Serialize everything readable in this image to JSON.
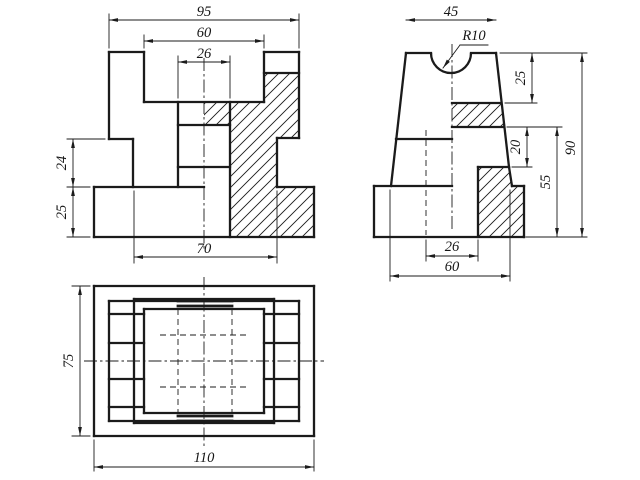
{
  "page": {
    "background": "#ffffff",
    "ink": "#1b1b1b",
    "width": 640,
    "height": 480
  },
  "views": {
    "front_view": {
      "name": "front-view-section",
      "dimensions": [
        {
          "label": "95",
          "x1": 109,
          "y1": 20,
          "x2": 299,
          "y2": 20,
          "tx": 204,
          "ty": 16,
          "rot": 0
        },
        {
          "label": "60",
          "x1": 144,
          "y1": 41,
          "x2": 264,
          "y2": 41,
          "tx": 204,
          "ty": 37,
          "rot": 0
        },
        {
          "label": "26",
          "x1": 178,
          "y1": 62,
          "x2": 230,
          "y2": 62,
          "tx": 204,
          "ty": 58,
          "rot": 0
        },
        {
          "label": "24",
          "x1": 73,
          "y1": 139,
          "x2": 73,
          "y2": 187,
          "tx": 66,
          "ty": 163,
          "rot": -90
        },
        {
          "label": "25",
          "x1": 73,
          "y1": 187,
          "x2": 73,
          "y2": 237,
          "tx": 66,
          "ty": 212,
          "rot": -90
        },
        {
          "label": "70",
          "x1": 134,
          "y1": 257,
          "x2": 277,
          "y2": 257,
          "tx": 204,
          "ty": 253,
          "rot": 0
        }
      ],
      "thick": [
        [
          109,
          52,
          144,
          52
        ],
        [
          144,
          52,
          144,
          102
        ],
        [
          144,
          102,
          264,
          102
        ],
        [
          264,
          102,
          264,
          52
        ],
        [
          264,
          52,
          299,
          52
        ],
        [
          299,
          52,
          299,
          138
        ],
        [
          299,
          138,
          277,
          138
        ],
        [
          277,
          138,
          277,
          187
        ],
        [
          277,
          187,
          314,
          187
        ],
        [
          314,
          187,
          314,
          237
        ],
        [
          314,
          237,
          94,
          237
        ],
        [
          94,
          237,
          94,
          187
        ],
        [
          94,
          187,
          204,
          187
        ],
        [
          133,
          187,
          133,
          139
        ],
        [
          133,
          139,
          109,
          139
        ],
        [
          109,
          139,
          109,
          52
        ],
        [
          264,
          73,
          299,
          73
        ],
        [
          178,
          102,
          178,
          187
        ],
        [
          230,
          102,
          230,
          237
        ],
        [
          178,
          125,
          230,
          125
        ],
        [
          178,
          167,
          230,
          167
        ]
      ],
      "thin": [
        [
          109,
          48,
          109,
          14
        ],
        [
          299,
          48,
          299,
          14
        ],
        [
          144,
          48,
          144,
          35
        ],
        [
          264,
          48,
          264,
          35
        ],
        [
          178,
          98,
          178,
          56
        ],
        [
          230,
          98,
          230,
          56
        ],
        [
          105,
          139,
          67,
          139
        ],
        [
          90,
          187,
          67,
          187
        ],
        [
          90,
          237,
          67,
          237
        ],
        [
          134,
          191,
          134,
          263
        ],
        [
          277,
          191,
          277,
          263
        ]
      ],
      "center": [
        [
          204,
          58,
          204,
          249
        ]
      ],
      "dashed": [],
      "hatch": [
        [
          [
            204,
            102
          ],
          [
            264,
            102
          ],
          [
            264,
            73
          ],
          [
            299,
            73
          ],
          [
            299,
            138
          ],
          [
            277,
            138
          ],
          [
            277,
            187
          ],
          [
            314,
            187
          ],
          [
            314,
            237
          ],
          [
            230,
            237
          ],
          [
            230,
            125
          ],
          [
            204,
            125
          ]
        ]
      ]
    },
    "side_view": {
      "name": "side-view-section",
      "dimensions": [
        {
          "label": "45",
          "x1": 406,
          "y1": 20,
          "x2": 496,
          "y2": 20,
          "tx": 451,
          "ty": 16,
          "rot": 0
        },
        {
          "label": "25",
          "x1": 532,
          "y1": 53,
          "x2": 532,
          "y2": 103,
          "tx": 525,
          "ty": 78,
          "rot": -90
        },
        {
          "label": "20",
          "x1": 527,
          "y1": 127,
          "x2": 527,
          "y2": 167,
          "tx": 520,
          "ty": 147,
          "rot": -90
        },
        {
          "label": "55",
          "x1": 557,
          "y1": 127,
          "x2": 557,
          "y2": 237,
          "tx": 550,
          "ty": 182,
          "rot": -90
        },
        {
          "label": "90",
          "x1": 582,
          "y1": 53,
          "x2": 582,
          "y2": 237,
          "tx": 575,
          "ty": 148,
          "rot": -90
        },
        {
          "label": "26",
          "x1": 426,
          "y1": 256,
          "x2": 478,
          "y2": 256,
          "tx": 452,
          "ty": 251,
          "rot": 0
        },
        {
          "label": "60",
          "x1": 390,
          "y1": 276,
          "x2": 510,
          "y2": 276,
          "tx": 452,
          "ty": 271,
          "rot": 0
        }
      ],
      "leaders": [
        {
          "label": "R10",
          "points": [
            [
              488,
              45
            ],
            [
              460,
              45
            ],
            [
              443,
              68
            ]
          ],
          "tx": 474,
          "ty": 40
        }
      ],
      "thick": [
        [
          406,
          53,
          431,
          53
        ],
        [
          471,
          53,
          496,
          53
        ],
        [
          406,
          53,
          391,
          186
        ],
        [
          496,
          53,
          509,
          167
        ],
        [
          509,
          167,
          512,
          186
        ],
        [
          396,
          139,
          452,
          139
        ],
        [
          374,
          186,
          452,
          186
        ],
        [
          374,
          186,
          374,
          237
        ],
        [
          374,
          237,
          524,
          237
        ],
        [
          524,
          237,
          524,
          186
        ],
        [
          524,
          186,
          512,
          186
        ],
        [
          452,
          103,
          501,
          103
        ],
        [
          452,
          127,
          504,
          127
        ],
        [
          478,
          167,
          509,
          167
        ],
        [
          478,
          167,
          478,
          237
        ]
      ],
      "arcs": [
        {
          "x1": 431,
          "y1": 53,
          "x2": 471,
          "y2": 53,
          "r": 20,
          "sweep": 0
        }
      ],
      "thin": [
        [
          500,
          53,
          587,
          53
        ],
        [
          505,
          103,
          537,
          103
        ],
        [
          507,
          127,
          562,
          127
        ],
        [
          512,
          167,
          532,
          167
        ],
        [
          526,
          237,
          587,
          237
        ],
        [
          478,
          240,
          478,
          261
        ],
        [
          426,
          240,
          426,
          261
        ],
        [
          390,
          190,
          390,
          281
        ],
        [
          510,
          190,
          510,
          281
        ]
      ],
      "center": [
        [
          452,
          44,
          452,
          232
        ]
      ],
      "dashed": [
        [
          426,
          130,
          426,
          235
        ]
      ],
      "hatch": [
        [
          [
            452,
            103
          ],
          [
            501,
            103
          ],
          [
            504,
            127
          ],
          [
            452,
            127
          ]
        ],
        [
          [
            478,
            167
          ],
          [
            509,
            167
          ],
          [
            512,
            186
          ],
          [
            524,
            186
          ],
          [
            524,
            237
          ],
          [
            478,
            237
          ]
        ]
      ]
    },
    "top_view": {
      "name": "top-view",
      "dimensions": [
        {
          "label": "75",
          "x1": 80,
          "y1": 286,
          "x2": 80,
          "y2": 436,
          "tx": 73,
          "ty": 361,
          "rot": -90
        },
        {
          "label": "110",
          "x1": 94,
          "y1": 467,
          "x2": 314,
          "y2": 467,
          "tx": 204,
          "ty": 462,
          "rot": 0
        }
      ],
      "thick": [
        [
          94,
          286,
          314,
          286
        ],
        [
          314,
          286,
          314,
          436
        ],
        [
          314,
          436,
          94,
          436
        ],
        [
          94,
          436,
          94,
          286
        ],
        [
          109,
          301,
          299,
          301
        ],
        [
          299,
          301,
          299,
          421
        ],
        [
          299,
          421,
          109,
          421
        ],
        [
          109,
          421,
          109,
          301
        ],
        [
          134,
          299,
          274,
          299
        ],
        [
          274,
          299,
          274,
          423
        ],
        [
          274,
          423,
          134,
          423
        ],
        [
          134,
          423,
          134,
          299
        ],
        [
          144,
          309,
          264,
          309
        ],
        [
          264,
          309,
          264,
          413
        ],
        [
          264,
          413,
          144,
          413
        ],
        [
          144,
          413,
          144,
          309
        ],
        [
          109,
          314,
          144,
          314
        ],
        [
          109,
          343,
          144,
          343
        ],
        [
          109,
          379,
          144,
          379
        ],
        [
          109,
          407,
          144,
          407
        ],
        [
          264,
          314,
          299,
          314
        ],
        [
          264,
          343,
          299,
          343
        ],
        [
          264,
          379,
          299,
          379
        ],
        [
          264,
          407,
          299,
          407
        ]
      ],
      "heavy": [
        [
          178,
          306,
          232,
          306
        ],
        [
          178,
          416,
          232,
          416
        ],
        [
          178,
          301,
          232,
          301
        ],
        [
          178,
          421,
          232,
          421
        ]
      ],
      "thin": [
        [
          90,
          286,
          72,
          286
        ],
        [
          90,
          436,
          72,
          436
        ],
        [
          94,
          440,
          94,
          471
        ],
        [
          314,
          440,
          314,
          471
        ]
      ],
      "center": [
        [
          204,
          277,
          204,
          446
        ],
        [
          84,
          361,
          324,
          361
        ]
      ],
      "dashed": [
        [
          178,
          309,
          178,
          413
        ],
        [
          232,
          309,
          232,
          413
        ],
        [
          160,
          335,
          248,
          335
        ],
        [
          160,
          387,
          248,
          387
        ]
      ],
      "hatch": []
    }
  },
  "style": {
    "thick_width": 2.3,
    "heavy_width": 2.8,
    "thin_width": 0.9,
    "dash_pattern": "6 4",
    "center_pattern": "13 3 2.5 3",
    "hatch_spacing": 11,
    "font_size": 14.5
  }
}
